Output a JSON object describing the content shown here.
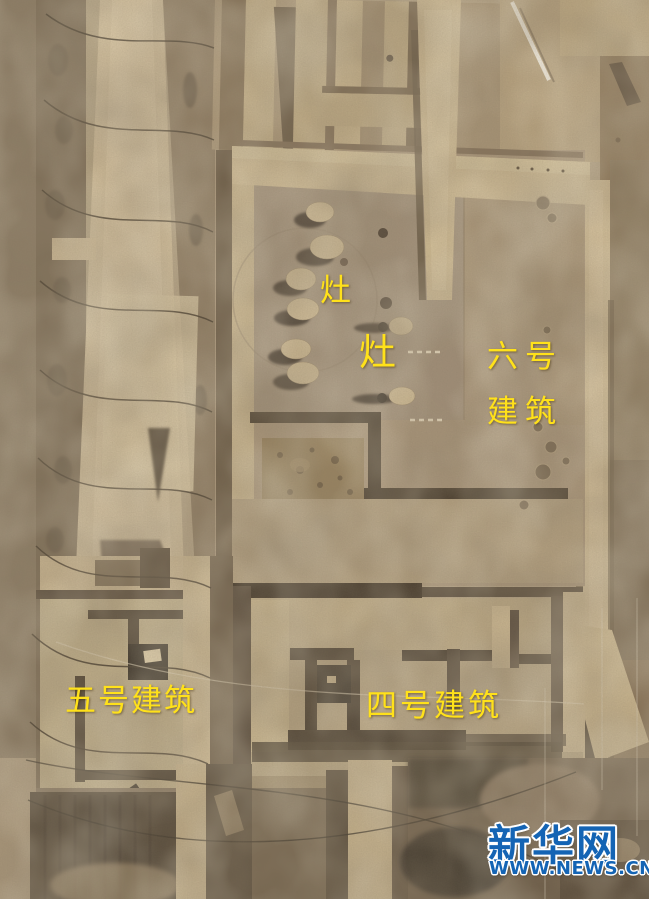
{
  "scene": {
    "description": "Aerial photograph of an archaeological excavation site with rammed-earth building foundations, hearth pits, survey strings and excavation baulks"
  },
  "annotations": {
    "color": "#ffe11a",
    "hearth_upper": "灶",
    "hearth_lower": "灶",
    "building6_line1": "六号",
    "building6_line2": "建筑",
    "building5": "五号建筑",
    "building4": "四号建筑"
  },
  "watermark": {
    "color": "#1464b4",
    "site_name": "新华网",
    "site_url": "WWW.NEWS.CN"
  }
}
